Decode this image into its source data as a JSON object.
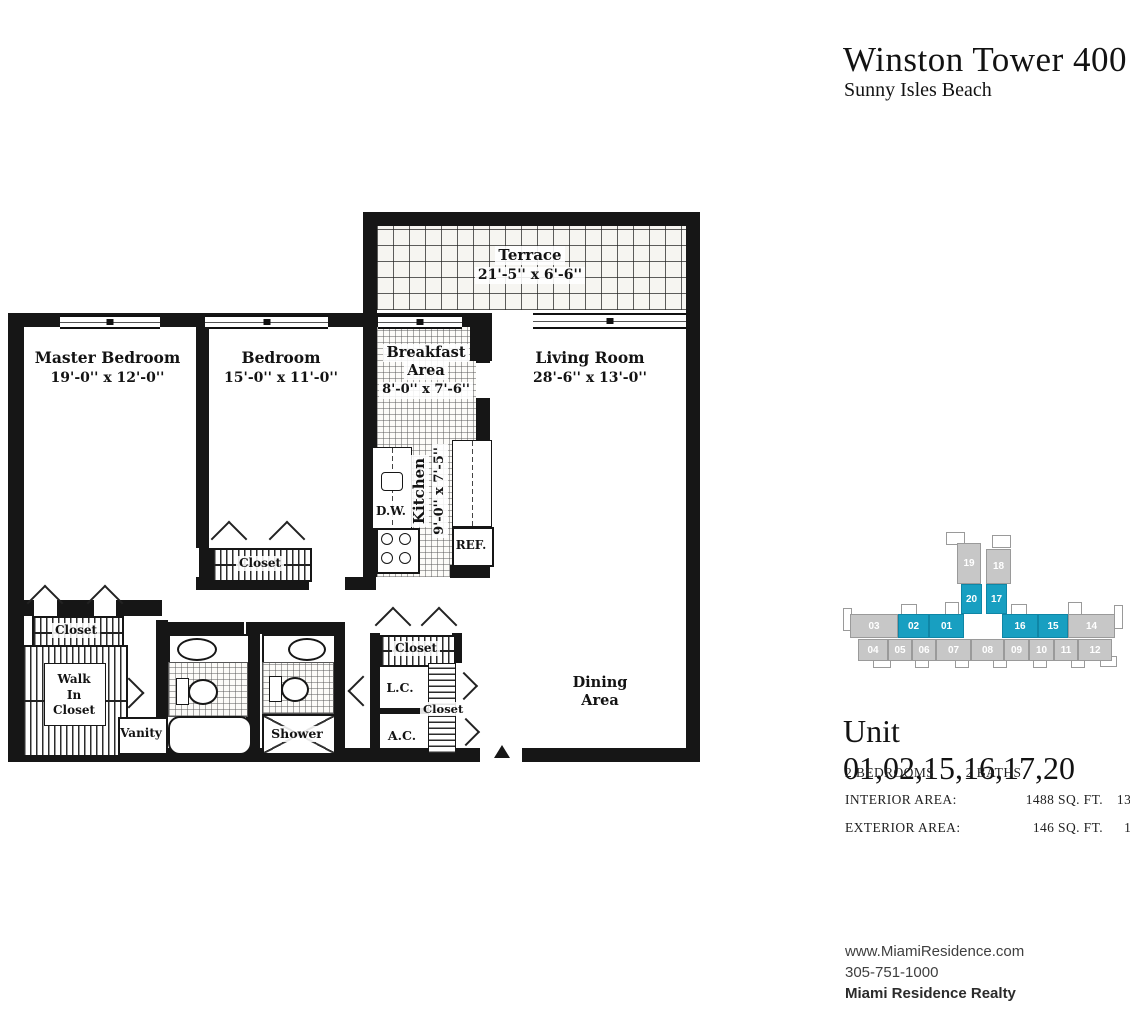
{
  "colors": {
    "accent": "#189fc1",
    "keyplan_gray": "#c7c7c7",
    "wall": "#161616"
  },
  "header": {
    "title": "Winston Tower 400",
    "subtitle": "Sunny Isles Beach"
  },
  "plan": {
    "terrace": {
      "name": "Terrace",
      "dims": "21'-5'' x 6'-6''"
    },
    "master_bedroom": {
      "name": "Master Bedroom",
      "dims": "19'-0'' x 12'-0''"
    },
    "bedroom": {
      "name": "Bedroom",
      "dims": "15'-0'' x 11'-0''"
    },
    "breakfast_area": {
      "name_line1": "Breakfast",
      "name_line2": "Area",
      "dims": "8'-0'' x 7'-6''"
    },
    "living_room": {
      "name": "Living Room",
      "dims": "28'-6'' x 13'-0''"
    },
    "kitchen": {
      "name": "Kitchen",
      "dims": "9'-0'' x 7'-5''"
    },
    "dining_area": {
      "name_line1": "Dining",
      "name_line2": "Area"
    },
    "labels": {
      "closet": "Closet",
      "walk_in_1": "Walk",
      "walk_in_2": "In",
      "walk_in_3": "Closet",
      "vanity": "Vanity",
      "shower": "Shower",
      "dishwasher": "D.W.",
      "refrigerator": "REF.",
      "linen_closet": "L.C.",
      "air_conditioner": "A.C."
    }
  },
  "keyplan": {
    "highlighted_units": [
      "01",
      "02",
      "15",
      "16",
      "17",
      "20"
    ],
    "units": [
      {
        "label": "19",
        "highlighted": false
      },
      {
        "label": "18",
        "highlighted": false
      },
      {
        "label": "20",
        "highlighted": true
      },
      {
        "label": "17",
        "highlighted": true
      },
      {
        "label": "03",
        "highlighted": false
      },
      {
        "label": "02",
        "highlighted": true
      },
      {
        "label": "01",
        "highlighted": true
      },
      {
        "label": "16",
        "highlighted": true
      },
      {
        "label": "15",
        "highlighted": true
      },
      {
        "label": "14",
        "highlighted": false
      },
      {
        "label": "04",
        "highlighted": false
      },
      {
        "label": "05",
        "highlighted": false
      },
      {
        "label": "06",
        "highlighted": false
      },
      {
        "label": "07",
        "highlighted": false
      },
      {
        "label": "08",
        "highlighted": false
      },
      {
        "label": "09",
        "highlighted": false
      },
      {
        "label": "10",
        "highlighted": false
      },
      {
        "label": "11",
        "highlighted": false
      },
      {
        "label": "12",
        "highlighted": false
      }
    ]
  },
  "unit_info": {
    "title": "Unit 01,02,15,16,17,20",
    "beds": "2 BEDROOMS",
    "baths": "2 BATHS",
    "interior_label": "INTERIOR AREA:",
    "interior_sqft": "1488 SQ. FT.",
    "interior_m2": "138 M²",
    "exterior_label": "EXTERIOR AREA:",
    "exterior_sqft": "146 SQ. FT.",
    "exterior_m2": "14 M²"
  },
  "footer": {
    "website": "www.MiamiResidence.com",
    "phone": "305-751-1000",
    "company": "Miami Residence Realty"
  }
}
